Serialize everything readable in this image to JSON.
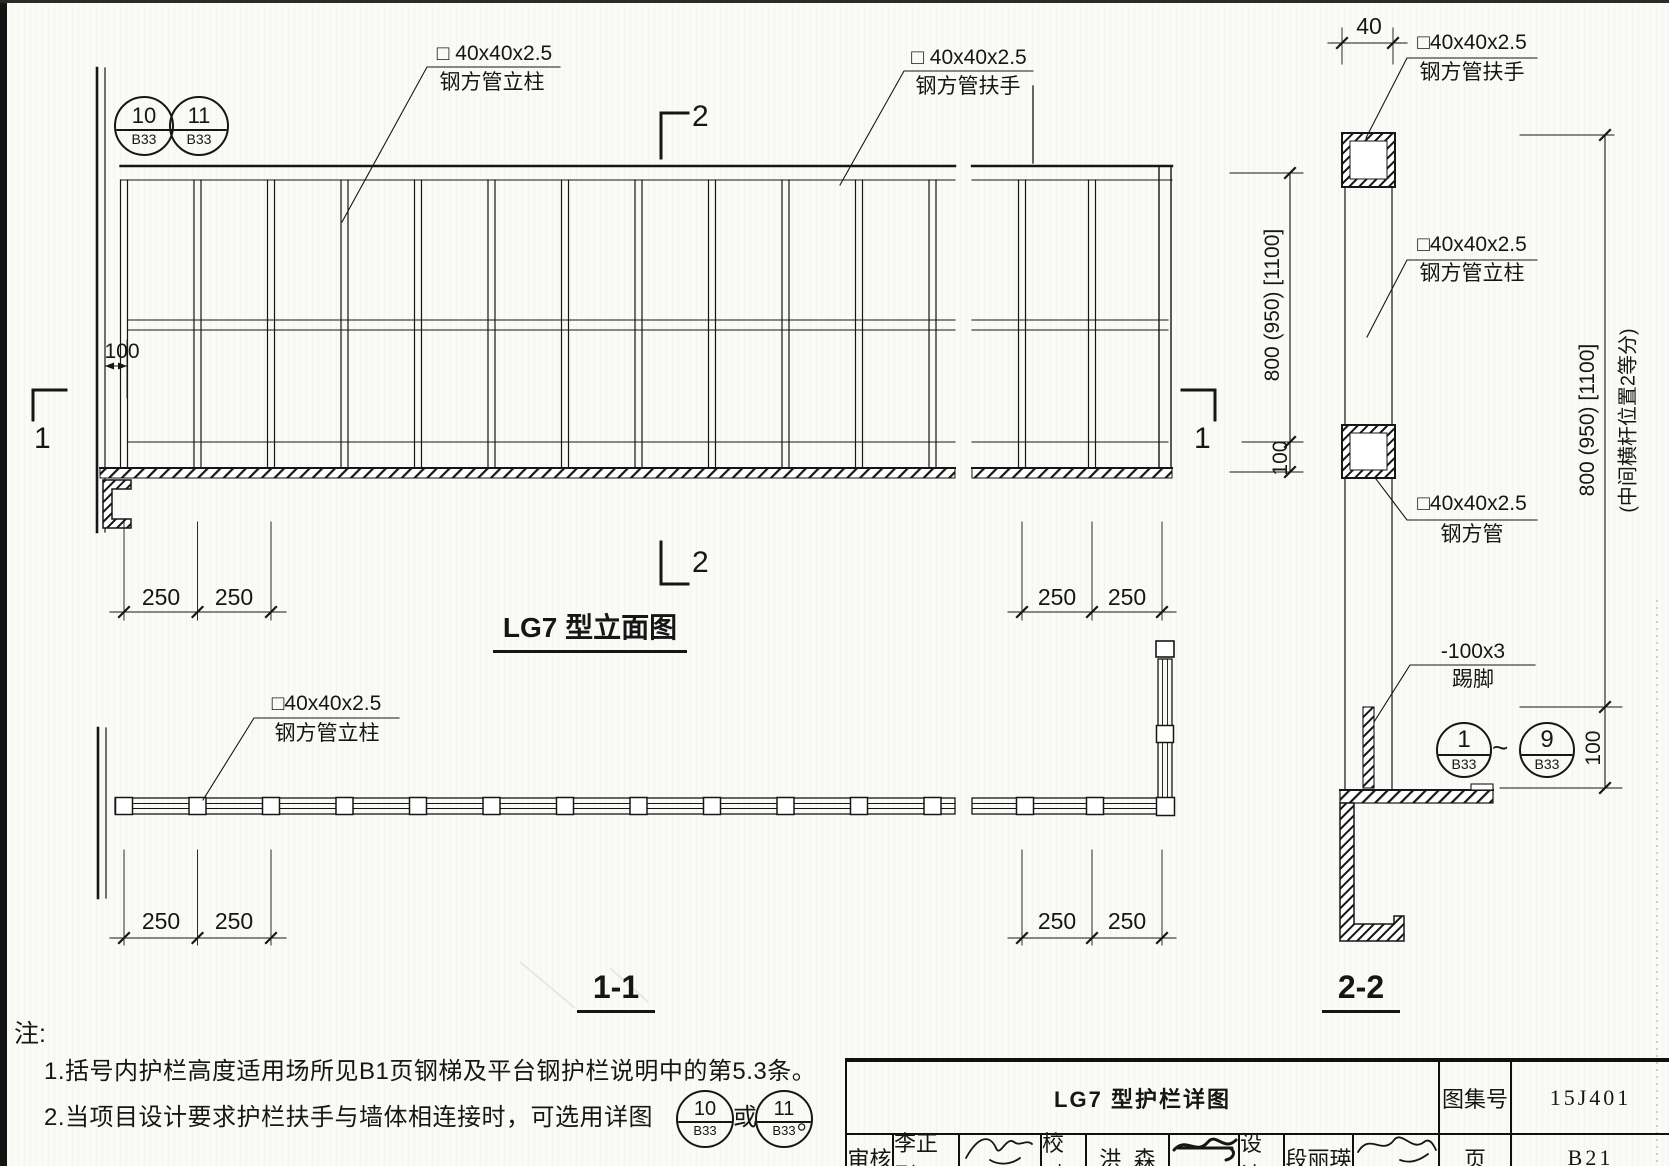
{
  "drawing": {
    "bubbles": {
      "b10": {
        "num": "10",
        "sheet": "B33"
      },
      "b11": {
        "num": "11",
        "sheet": "B33"
      },
      "b1": {
        "num": "1",
        "sheet": "B33"
      },
      "b9": {
        "num": "9",
        "sheet": "B33"
      },
      "tilde": "~"
    },
    "labels": {
      "elev_post": {
        "spec": "□ 40x40x2.5",
        "name": "钢方管立柱"
      },
      "elev_rail": {
        "spec": "□ 40x40x2.5",
        "name": "钢方管扶手"
      },
      "plan_post": {
        "spec": "□40x40x2.5",
        "name": "钢方管立柱"
      },
      "sec_rail": {
        "spec": "□40x40x2.5",
        "name": "钢方管扶手"
      },
      "sec_post": {
        "spec": "□40x40x2.5",
        "name": "钢方管立柱"
      },
      "sec_mid": {
        "spec": "□40x40x2.5",
        "name": "钢方管"
      },
      "sec_kick": {
        "spec": "-100x3",
        "name": "踢脚"
      }
    },
    "dims": {
      "bay": "250",
      "gap100": "100",
      "tube40": "40",
      "height": "800 (950) [1100]",
      "height_note": "(中间横杆位置2等分)"
    },
    "marks": {
      "m1": "1",
      "m2": "2"
    },
    "titles": {
      "elevation": "LG7 型立面图",
      "sec11": "1-1",
      "sec22": "2-2"
    }
  },
  "notes": {
    "head": "注:",
    "n1": "1.括号内护栏高度适用场所见B1页钢梯及平台钢护栏说明中的第5.3条。",
    "n2a": "2.当项目设计要求护栏扶手与墙体相连接时，可选用详图",
    "n2b": "或",
    "n2c": "。"
  },
  "titleblock": {
    "title": "LG7 型护栏详图",
    "atlas_label": "图集号",
    "atlas_no": "15J401",
    "page_label": "页",
    "page_no": "B21",
    "audit_label": "审核",
    "audit_name": "李正刚",
    "check_label": "校对",
    "check_name": "洪  森",
    "design_label": "设计",
    "design_name": "段丽瑛"
  }
}
